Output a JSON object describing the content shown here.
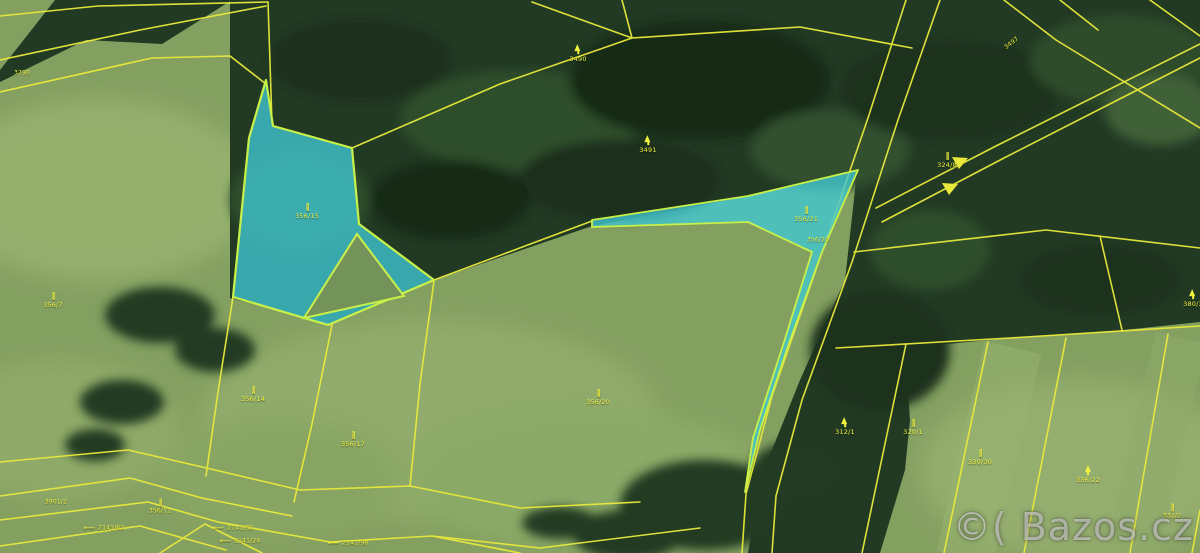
{
  "meta": {
    "view": "cadastral-map-over-aerial-imagery",
    "width_px": 1200,
    "height_px": 553
  },
  "watermark": {
    "text": "©( Bazos.cz"
  },
  "colors": {
    "parcel_line": "#e9e93c",
    "label_text": "#f2f23e",
    "highlight_fill": "#40c8d4",
    "highlight_stroke": "#c8f048",
    "forest": "#223a24",
    "field": "#84a061"
  },
  "highlighted_parcels": [
    {
      "id": "356/15",
      "shape": "polygon-left"
    },
    {
      "id": "356/21",
      "shape": "triangle-and-sliver-right"
    }
  ],
  "symbol_legend": {
    "grass": "permanent-grassland-symbol",
    "conifer": "forest-parcel-symbol"
  },
  "labels": [
    {
      "num": "3790",
      "x": 22,
      "y": 74,
      "size": 6
    },
    {
      "num": "3490",
      "symbol": "conifer",
      "x": 578,
      "y": 55
    },
    {
      "num": "3491",
      "symbol": "conifer",
      "x": 648,
      "y": 146
    },
    {
      "num": "356/15",
      "symbol": "grass",
      "x": 307,
      "y": 213
    },
    {
      "num": "356/21",
      "symbol": "grass",
      "x": 806,
      "y": 216
    },
    {
      "num": "356/20",
      "x": 818,
      "y": 241,
      "size": 6
    },
    {
      "num": "324/8",
      "symbol": "grass",
      "x": 947,
      "y": 162
    },
    {
      "num": "3497",
      "x": 1012,
      "y": 44,
      "rotate": -38,
      "size": 6
    },
    {
      "num": "356/7",
      "symbol": "grass",
      "x": 53,
      "y": 302
    },
    {
      "num": "356/14",
      "symbol": "grass",
      "x": 253,
      "y": 396
    },
    {
      "num": "356/17",
      "symbol": "grass",
      "x": 353,
      "y": 441
    },
    {
      "num": "356/20",
      "symbol": "grass",
      "x": 598,
      "y": 399
    },
    {
      "num": "312/1",
      "symbol": "conifer",
      "x": 845,
      "y": 428
    },
    {
      "num": "320/1",
      "symbol": "grass",
      "x": 913,
      "y": 429
    },
    {
      "num": "330/30",
      "symbol": "grass",
      "x": 980,
      "y": 459
    },
    {
      "num": "336/22",
      "symbol": "conifer",
      "x": 1088,
      "y": 476
    },
    {
      "num": "380/3",
      "symbol": "conifer",
      "x": 1193,
      "y": 300
    },
    {
      "num": "332/2",
      "symbol": "grass",
      "x": 1172,
      "y": 513,
      "size": 6
    },
    {
      "num": "3901/2",
      "x": 56,
      "y": 503,
      "size": 6
    },
    {
      "num": "356/11",
      "symbol": "grass",
      "x": 160,
      "y": 508,
      "size": 6
    },
    {
      "num": "2141/62",
      "arrow": "left",
      "x": 104,
      "y": 529,
      "size": 6
    },
    {
      "num": "2141/32",
      "arrow": "left",
      "x": 233,
      "y": 529,
      "size": 6
    },
    {
      "num": "2141/24",
      "arrow": "left",
      "x": 240,
      "y": 542,
      "size": 6
    },
    {
      "num": "2141/98",
      "arrow": "left",
      "x": 348,
      "y": 544,
      "size": 6
    }
  ]
}
